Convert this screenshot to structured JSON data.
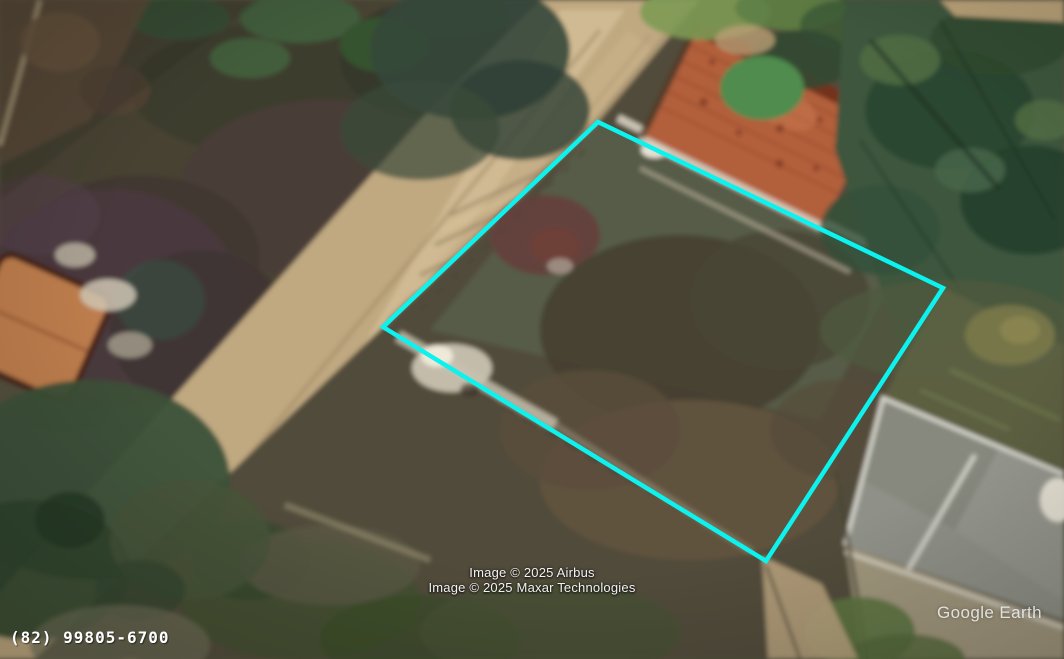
{
  "viewport": {
    "app_watermark": "Google Earth"
  },
  "overlay": {
    "plot_outline_points": "598,122 943,288 766,561 383,327",
    "plot_outline_color": "#0CF2EE"
  },
  "attribution": {
    "line1": "Image © 2025 Airbus",
    "line2": "Image © 2025 Maxar Technologies"
  },
  "contact_overlay": {
    "phone": "(82) 99805-6700"
  }
}
